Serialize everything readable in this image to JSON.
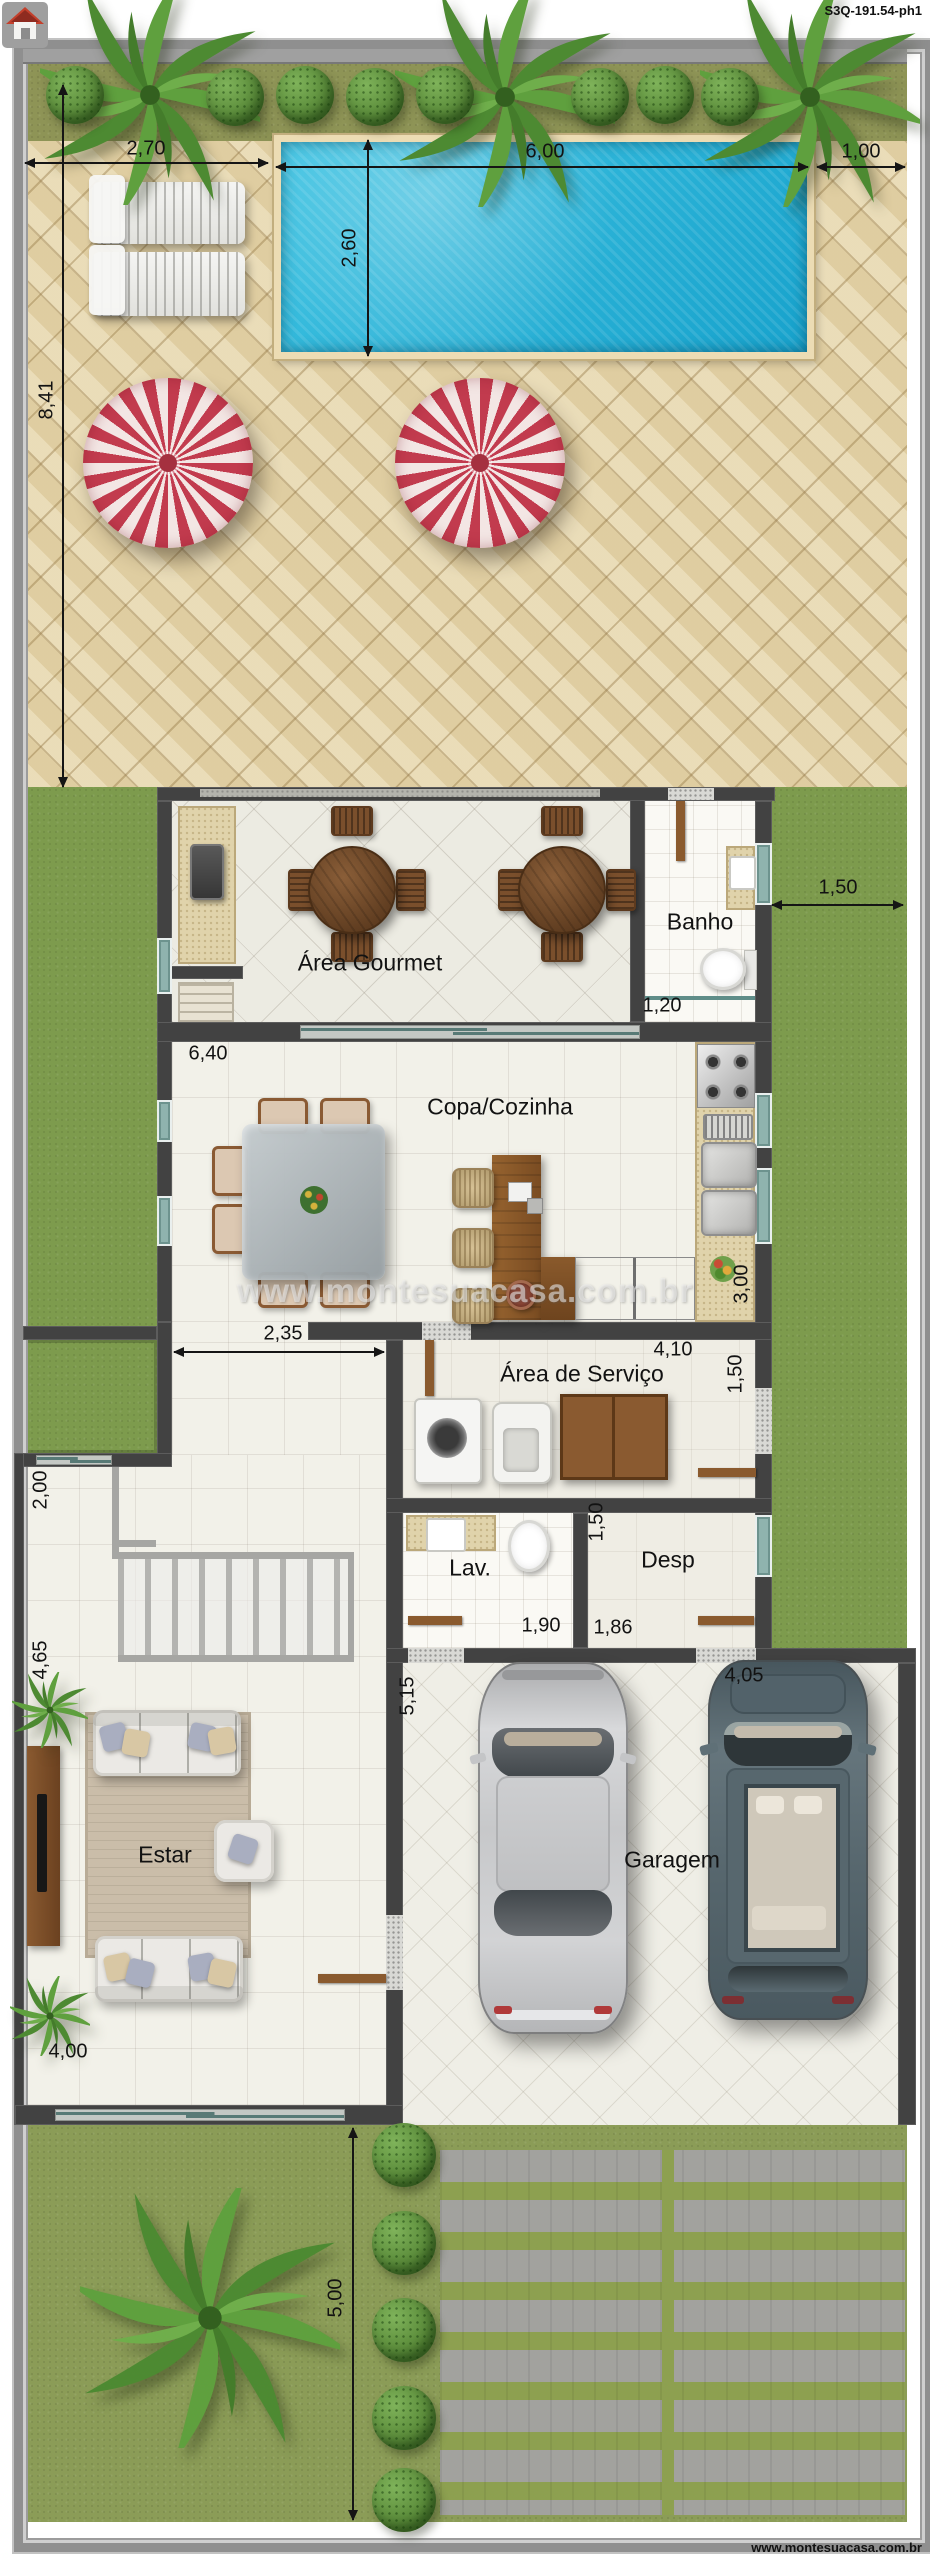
{
  "header": {
    "plan_code": "S3Q-191.54-ph1",
    "logo": "house-icon"
  },
  "footer": {
    "website": "www.montesuacasa.com.br"
  },
  "watermark": {
    "text": "www.montesuacasa.com.br"
  },
  "rooms": {
    "area_gourmet": "Área Gourmet",
    "banho": "Banho",
    "copa_cozinha": "Copa/Cozinha",
    "area_servico": "Área de Serviço",
    "lavabo": "Lav.",
    "despensa": "Desp",
    "estar": "Estar",
    "garagem": "Garagem"
  },
  "dimensions": {
    "deck_left": "2,70",
    "pool_length": "6,00",
    "deck_right": "1,00",
    "pool_width": "2,60",
    "patio_depth": "8,41",
    "right_setback": "1,50",
    "banho_door": "1,20",
    "cozinha_width": "6,40",
    "cozinha_depth": "3,00",
    "hall_width": "2,35",
    "servico_width": "4,10",
    "servico_depth": "1,50",
    "desp_zone_depth": "1,50",
    "lavabo_width": "1,90",
    "despensa_width": "1,86",
    "garagem_depth": "5,15",
    "garagem_width": "4,05",
    "entry_garden_depth": "2,00",
    "stair_zone_depth": "4,65",
    "estar_width": "4,00",
    "front_setback": "5,00"
  },
  "colors": {
    "pool_water": "#27b4da",
    "patio_tile": "#e7d7ad",
    "grass_side": "#7d9b4d",
    "grass_front": "#8b9c57",
    "wall": "#424242",
    "umbrella_red": "#c23b4e",
    "wood": "#7d5231",
    "window_glass": "#8fb3ae"
  }
}
